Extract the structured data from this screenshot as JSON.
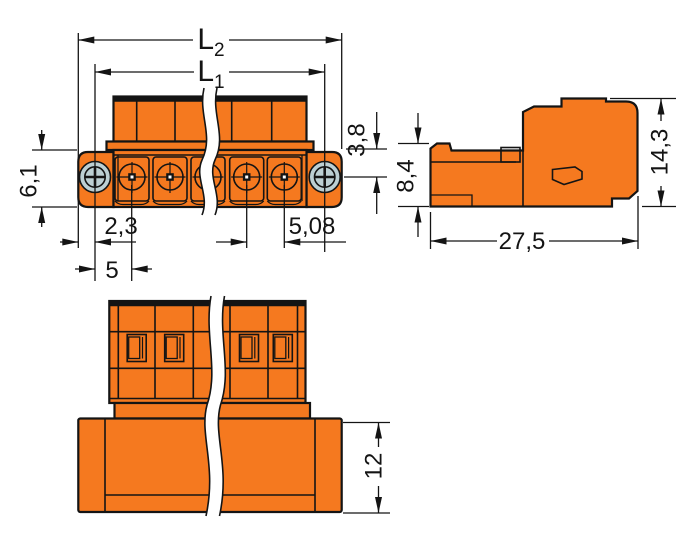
{
  "drawing": {
    "type": "technical-dimensional-drawing",
    "colors": {
      "housing_orange": "#f5791f",
      "contact_yellow": "#f7ee2a",
      "screw_silver": "#bccfd3",
      "outline_black": "#141414",
      "background_white": "#ffffff"
    },
    "front": {
      "dims": {
        "l2": {
          "main": "L",
          "sub": "2"
        },
        "l1": {
          "main": "L",
          "sub": "1"
        },
        "flange_height": "6,1",
        "pin_depth": "3,8",
        "edge_to_pin": "2,3",
        "pin_pitch": "5,08",
        "flange_to_pin": "5"
      }
    },
    "side": {
      "dims": {
        "front_height": "8,4",
        "total_height": "14,3",
        "total_depth": "27,5"
      }
    },
    "bottom": {
      "dims": {
        "plug_depth": "12"
      }
    }
  }
}
